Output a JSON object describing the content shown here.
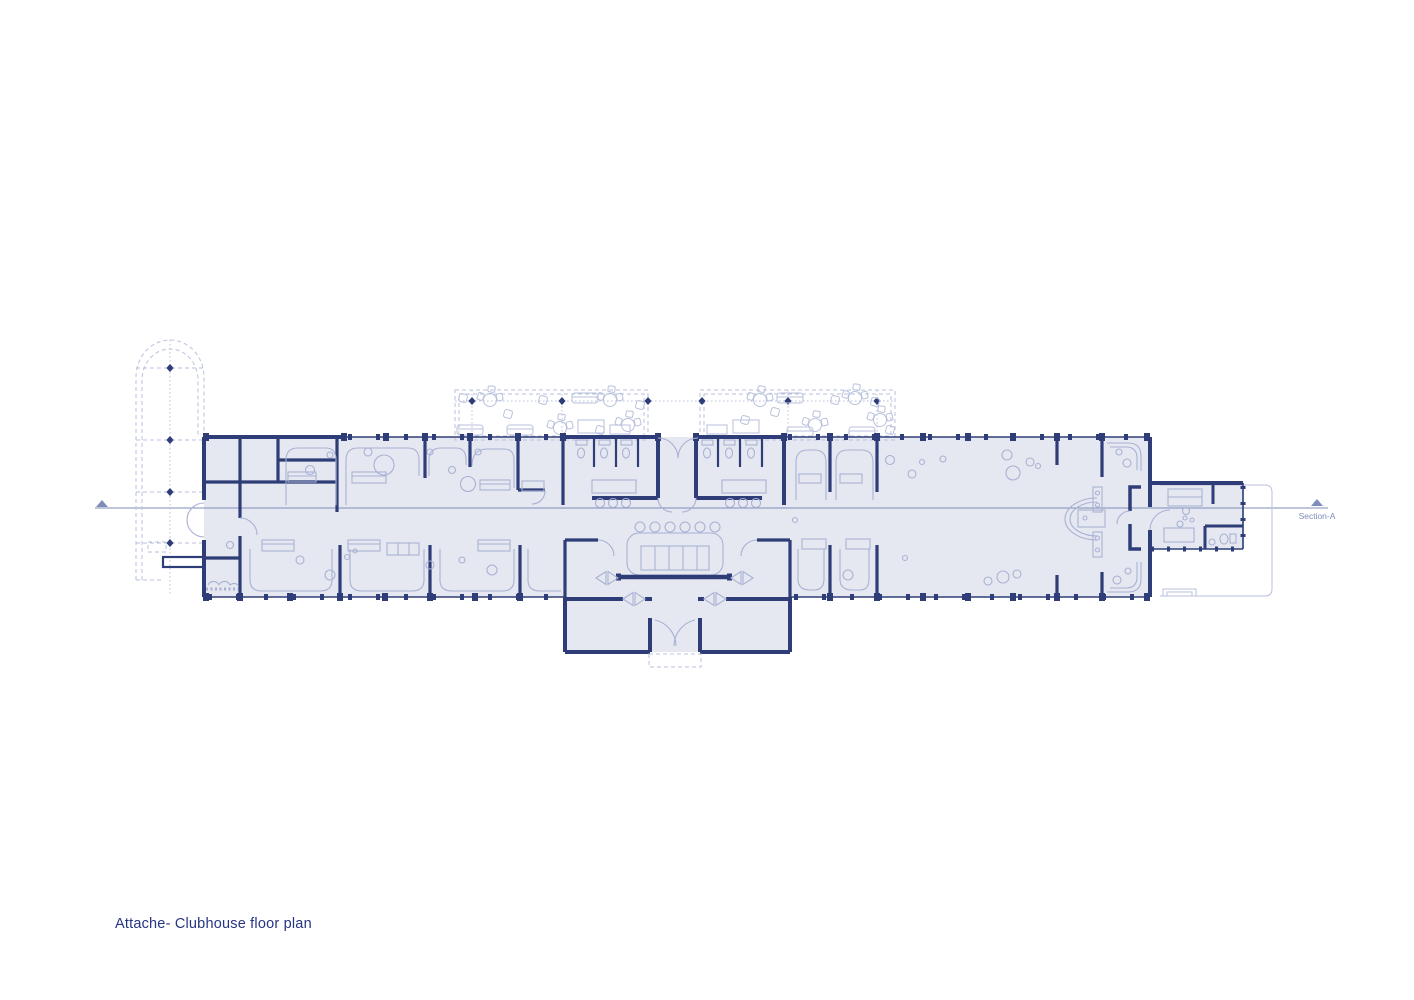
{
  "sheet": {
    "title": "Attache- Clubhouse floor plan"
  },
  "section": {
    "label": "Section-A"
  },
  "colors": {
    "background": "#ffffff",
    "wall": "#2e3d77",
    "floor": "#e6e8f1",
    "furniture": "#a8b1d3",
    "light_line": "#b9c1dc",
    "section_line": "#7e8cb8",
    "title_text": "#263582"
  }
}
